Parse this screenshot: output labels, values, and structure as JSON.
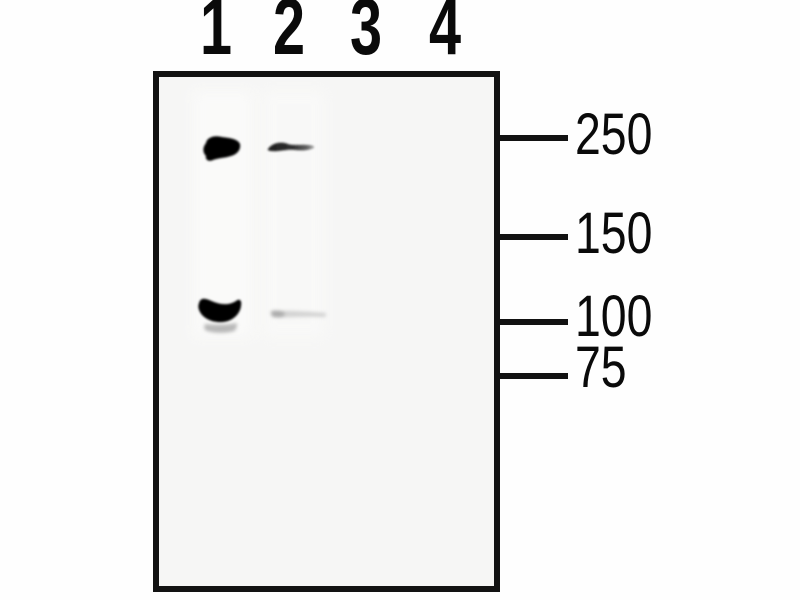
{
  "figure": {
    "kind": "western-blot-panel",
    "colors": {
      "page_background": "#fefefe",
      "panel_background": "#f6f6f5",
      "border": "#121212",
      "text": "#0a0a0a"
    },
    "lane_labels": [
      {
        "label": "1"
      },
      {
        "label": "2"
      },
      {
        "label": "3"
      },
      {
        "label": "4"
      }
    ],
    "mw_markers": [
      {
        "label": "250"
      },
      {
        "label": "150"
      },
      {
        "label": "100"
      },
      {
        "label": "75"
      }
    ],
    "bands": [
      {
        "name": "lane1-membrane-smudge",
        "lane": 1,
        "near_marker": "",
        "intensity": "background",
        "path": "M193,90 L253,90 L253,338 L193,338 Z",
        "fill": "#fbfbfa",
        "opacity": 0.8,
        "blur": "blur3"
      },
      {
        "name": "lane2-membrane-smudge",
        "lane": 2,
        "near_marker": "",
        "intensity": "background",
        "path": "M263,90 L325,90 L325,338 L263,338 Z",
        "fill": "#fafaf9",
        "opacity": 0.7,
        "blur": "blur3"
      },
      {
        "name": "band-lane1-250",
        "lane": 1,
        "near_marker": "250",
        "intensity": "strong",
        "path": "M206,143 C207,137 215,135 222,137 C230,138 238,139 240,144 C241,149 238,154 231,156 C225,158 218,158 213,160 C209,162 205,160 206,156 C203,153 202,148 206,143 Z",
        "fill": "#060606",
        "opacity": 1,
        "blur": "blur1"
      },
      {
        "name": "band-lane2-250",
        "lane": 2,
        "near_marker": "250",
        "intensity": "medium",
        "path": "M268,149 C272,143 281,141 288,144 C294,146 302,144 308,145 C312,145 315,146 314,148 C310,150 303,151 295,150 C286,149 278,152 272,151 C269,151 267,150 268,149 Z",
        "fill": "url(#fadeR)",
        "opacity": 0.95,
        "blur": "blur1"
      },
      {
        "name": "band-lane1-100",
        "lane": 1,
        "near_marker": "100",
        "intensity": "strong",
        "path": "M199,303 C201,296 207,299 214,302 C222,305 230,305 236,301 C240,298 242,301 241,306 C240,314 233,321 223,322 C212,323 203,318 200,312 C198,308 198,306 199,303 Z",
        "fill": "#040404",
        "opacity": 1,
        "blur": "blur1"
      },
      {
        "name": "band-lane1-100-subband",
        "lane": 1,
        "near_marker": "100",
        "intensity": "faint",
        "path": "M205,324 C215,325 228,325 237,323 C237,327 236,330 234,331 C224,334 211,333 205,330 C204,328 204,326 205,324 Z",
        "fill": "#8c8c8c",
        "opacity": 0.6,
        "blur": "blur2"
      },
      {
        "name": "band-lane2-100-streak",
        "lane": 2,
        "near_marker": "100",
        "intensity": "very-faint",
        "path": "M272,312 C282,310 300,311 326,313 C326,315 326,316 325,317 C305,316 284,318 272,317 Z",
        "fill": "#aeaeae",
        "opacity": 0.5,
        "blur": "blur2"
      },
      {
        "name": "band-lane2-100-left-blob",
        "lane": 2,
        "near_marker": "100",
        "intensity": "very-faint",
        "path": "M271,311 C276,310 281,311 285,313 C285,315 283,317 279,317 C275,317 271,316 271,314 Z",
        "fill": "#909090",
        "opacity": 0.6,
        "blur": "blur2"
      }
    ]
  }
}
